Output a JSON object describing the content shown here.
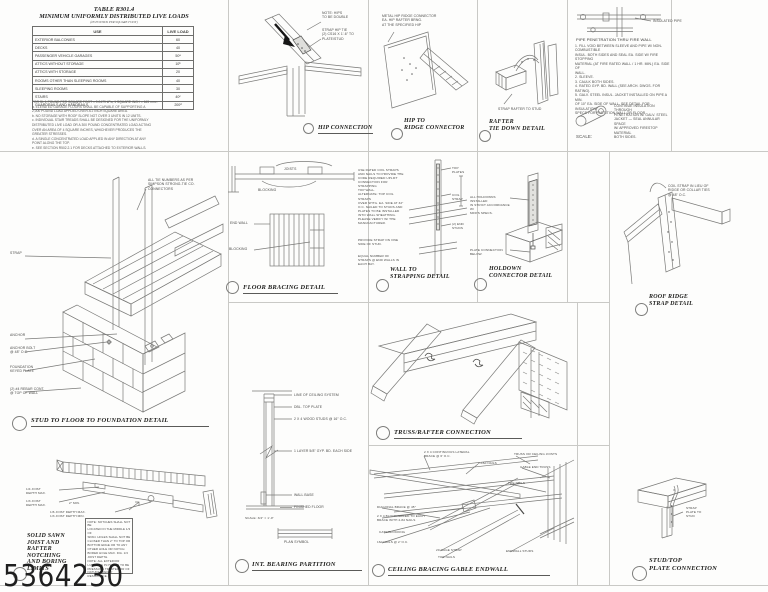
{
  "watermark": "5364230",
  "colors": {
    "linework": "#7a7a78",
    "title_ink": "#1d1d1b",
    "divider": "#c9c9c6",
    "watermark_ink": "#1f1f1f"
  },
  "table": {
    "title_line1": "TABLE R301.4",
    "title_line2": "MINIMUM UNIFORMLY DISTRIBUTED LIVE LOADS",
    "subtitle": "(IN POUNDS PER SQUARE FOOT)",
    "headers": {
      "use": "USE",
      "load": "LIVE LOAD"
    },
    "rows": [
      {
        "use": "EXTERIOR BALCONIES",
        "load": "60"
      },
      {
        "use": "DECKS",
        "load": "40"
      },
      {
        "use": "PASSENGER VEHICLE GARAGES",
        "load": "50ᵃ"
      },
      {
        "use": "ATTICS WITHOUT STORAGE",
        "load": "10ᵇ"
      },
      {
        "use": "ATTICS WITH STORAGE",
        "load": "20"
      },
      {
        "use": "ROOMS OTHER THAN SLEEPING ROOMS",
        "load": "40"
      },
      {
        "use": "SLEEPING ROOMS",
        "load": "30"
      },
      {
        "use": "STAIRS",
        "load": "40ᶜ"
      },
      {
        "use": "GUARDRAILS AND HANDRAILS",
        "load": "200ᵈ"
      }
    ],
    "footnotes": "FOR SI: 1 POUND PER SQUARE FOOT = 0.0479 kPa, 1 SQUARE INCH = 645 mm².\na. ELEVATED GARAGE FLOORS SHALL BE CAPABLE OF SUPPORTING A\n    2,000 POUND LOAD APPLIED OVER A 2 INCH SQUARE AREA.\nb. NO STORAGE WITH ROOF SLOPE NOT OVER 3 UNITS IN 12 UNITS.\nc. INDIVIDUAL STAIR TREADS SHALL BE DESIGNED FOR THE UNIFORMLY\n    DISTRIBUTED LIVE LOAD OR A 300 POUND CONCENTRATED LOAD ACTING\n    OVER AN AREA OF 4 SQUARE INCHES, WHICHEVER PRODUCES THE\n    GREATER STRESSES.\nd. A SINGLE CONCENTRATED LOAD APPLIED IN ANY DIRECTION AT ANY\n    POINT ALONG THE TOP.\ne. SEE SECTION R502.2.1 FOR DECKS ATTACHED TO EXTERIOR WALLS."
  },
  "panels": {
    "hip_connection": {
      "title": "HIP CONNECTION",
      "label_note": "NOTE: HIPS\nTO BE DOUBLE",
      "label_strap": "STRAP HIP TIE\n(2) CS16 X 1'-6\" TO PLATE/STUD"
    },
    "hip_to_ridge": {
      "title": "HIP TO\nRIDGE CONNECTOR",
      "note": "METAL HIP RIDGE CONNECTOR\nEA. HIP RAFTER BRNG.\nAT THE SPECIFIED HIP"
    },
    "rafter_tie_down": {
      "title": "RAFTER\nTIE DOWN DETAIL",
      "label": "STRAP RAFTER TO STUD"
    },
    "fire_wall_notes": {
      "pipe_label": "INSULATED PIPE",
      "heading": "PIPE PENETRATION THRU FIRE WALL",
      "notes": "1. FILL VOID BETWEEN SLEEVE AND PIPE W/ NON-COMBUSTIBLE\n    INSUL. BOTH SIDES AND SEAL EA. SIDE W/ FIRE STOPPING\n    MATERIAL (AT FIRE RATED WALL / 1 HR. MIN.) EA. SIDE OF\n    WALL.\n2. SLEEVE.\n3. CAULK BOTH SIDES.\n4. RATED GYP. BD. WALL (SEE ARCH. DWGS. FOR RATING).\n5. GALV. STEEL INSUL. JACKET INSTALLED ON PIPE A MIN.\n    OF 10\" EA. SIDE OF WALL. SEE DETAIL FOR INSULATION\n    SPECS FOR PARTITION WALL OR FLOOR.",
      "side_note": "CONTINUE INSULATION THROUGH\nPENETRATION W/ GALV. STEEL\nJACKET — SEAL ANNULAR SPACE\nW/ APPROVED FIRESTOP MATERIAL\nBOTH SIDES.",
      "scale_label": "SCALE:"
    },
    "floor_bracing": {
      "title": "FLOOR BRACING DETAIL",
      "label_joists": "JOISTS",
      "label_blocking_sec": "BLOCKING",
      "label_endwall": "END WALL",
      "label_blocking_plan": "BLOCKING"
    },
    "wall_to_strapping": {
      "title": "WALL TO\nSTRAPPING DETAIL",
      "note1": "USE RATED COIL STRAPS\nAND NAILS TO PROVIDE THE\nCODE REQUIRED UPLIFT\nCONNECTION FOR STRAPPING\nTOP WALL.\nALTERNATE: TOP COIL STRAPS\nOVER SHTG. EA. SIDE AT 32\"\nO.C. NAILED TO STUDS AND\nPLATES TO BE INSTALLED\nINTO WALL SHEATHING.\nPLEASE VERIFY W/ THE\nMANUFACTURER.",
      "note2": "PROVIDE STRAP ON ONE\nSIDE OF STUD.",
      "note3": "EQUAL NUMBER OF\nSTRAPS @ END WALLS IN\nEACH BAY.",
      "label_top_plates": "TOP\nPLATES",
      "label_coil_strap": "COIL\nSTRAP",
      "label_end_studs": "(2) END\nSTUDS"
    },
    "holdown": {
      "title": "HOLDOWN\nCONNECTOR DETAIL",
      "note1": "ALL HOLDOWNS INSTALLED\nIN STRICT ACCORDANCE W/\nMFR'S SPECS.",
      "note2": "PLATE CONNECTION\nBELOW."
    },
    "roof_ridge_strap": {
      "title": "ROOF RIDGE\nSTRAP DETAIL",
      "label": "COIL STRAP IN LIEU OF\nRIDGE OR COLLAR TIES\n@ 48\" O.C."
    },
    "stud_to_floor": {
      "title": "STUD TO FLOOR TO FOUNDATION DETAIL",
      "note": "ALL TIE NUMBERS AS PER\nSIMPSON STRONG-TIE CO.\nCONNECTORS",
      "label_strap": "STRAP",
      "label_anchor": "ANCHOR",
      "label_anchor_bolt": "ANCHOR BOLT\n@ 48\" O.C.",
      "label_foundation": "FOUNDATION\nKEYED PLATE",
      "label_rebar": "(2) #4 REBAR CONT.\n@ TOP OF WALL"
    },
    "truss_rafter": {
      "title": "TRUSS/RAFTER CONNECTION"
    },
    "int_bearing": {
      "title": "INT. BEARING PARTITION",
      "labels": [
        "LINE OF CEILING SYSTEM",
        "DBL. TOP PLATE",
        "2 X 4 WOOD STUDS @ 16\" O.C.",
        "1 LAYER 5/8\" GYP. BD. EACH SIDE",
        "WALL BASE",
        "FINISHED FLOOR"
      ],
      "scale_note": "SCALE: 3/4\" = 1'-0\"",
      "plan_label": "PLAN SYMBOL"
    },
    "ceiling_bracing": {
      "title": "CEILING BRACING GABLE ENDWALL",
      "labels": [
        "2 X 4 CONTINUOUS LATERAL\nBRACE @ 6' O.C.",
        "2-16d NAILS",
        "TRUSS OR CEILING JOISTS",
        "GABLE END TRUSS",
        "TOE NAILS",
        "DIAGONAL BRACE @ 45°",
        "2 X 4 BLOCK NAILED TO EACH\nBRACE WITH 4-8d NAILS",
        "CATS/BLOCKING",
        "16d NAILS @ 2' O.C.",
        "20 GAGE STRAP",
        "TOE NAILS",
        "ENDWALL STUDS"
      ]
    },
    "stud_top_plate": {
      "title": "STUD/TOP\nPLATE CONNECTION",
      "label": "STRAP\nPLATE TO\nSTUD"
    },
    "solid_sawn": {
      "title": "SOLID SAWN\nJOIST AND\nRAFTER\nNOTCHING\nAND BORING\nLIMITS",
      "label_quarter": "1/4 JOIST\nDEPTH MAX.",
      "label_third": "1/3 JOIST\nDEPTH MAX.",
      "label_2min": "2\" MIN.",
      "label_sixth": "1/6 JOIST DEPTH MAX.\n1/3 JOIST DEPTH MIN.",
      "note": "NOTE: NOTCHES SHALL NOT BE\nLOCATED IN THE MIDDLE 1/3 OF\nSPAN. HOLES SHALL NOT BE\nCLOSER THAN 2\" TO TOP OR\nBOTTOM EDGE OR TO ANY\nOTHER HOLE OR NOTCH.\nBORED HOLE MAX. DIA. 1/3\nJOIST DEPTH.\nNOTE: ALL EXTERIOR\nLUMBER & PLYWOOD TO BE\nPRESSURE TREATED OR OF\nNATURAL DECAY RESISTANCE."
    }
  }
}
